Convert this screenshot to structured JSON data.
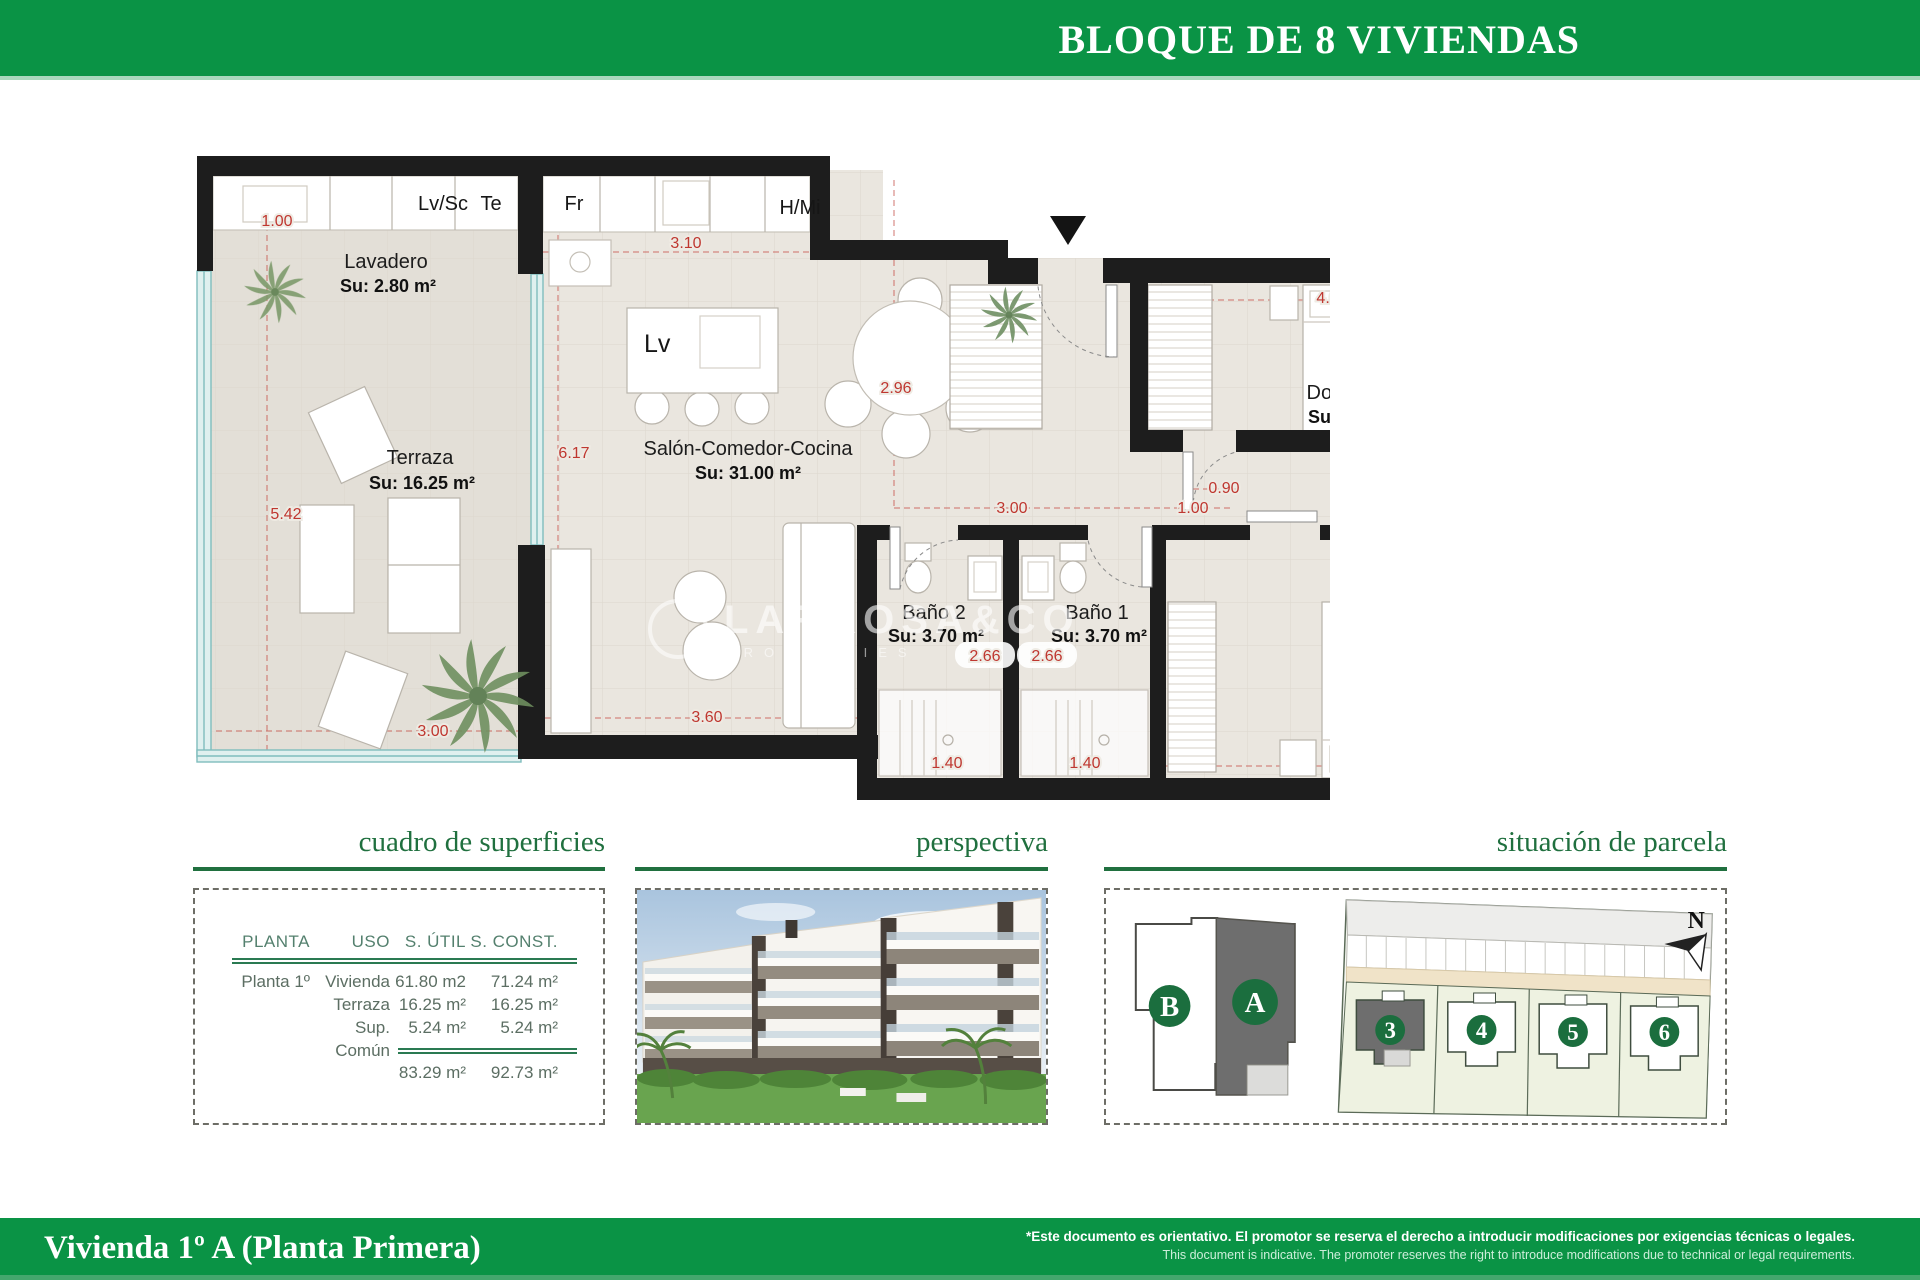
{
  "header": {
    "title": "BLOQUE DE 8 VIVIENDAS"
  },
  "plan": {
    "fixtures": {
      "lvsc": "Lv/Sc",
      "te": "Te",
      "fr": "Fr",
      "hmi": "H/Mi",
      "lv": "Lv"
    },
    "rooms": {
      "lavadero": {
        "name": "Lavadero",
        "su": "Su: 2.80 m²"
      },
      "terraza": {
        "name": "Terraza",
        "su": "Su: 16.25 m²"
      },
      "salon": {
        "name": "Salón-Comedor-Cocina",
        "su": "Su: 31.00 m²"
      },
      "bano2": {
        "name": "Baño 2",
        "su": "Su: 3.70 m²"
      },
      "bano1": {
        "name": "Baño 1",
        "su": "Su: 3.70 m²"
      },
      "dorm2": {
        "name": "Dormitorio 2",
        "su": "Su: 10.00 m²"
      },
      "dorm1": {
        "name": "Dormitorio 1",
        "su": "Su: 10.60 m²"
      }
    },
    "dims": {
      "left_top": "1.00",
      "kitchen_width": "3.10",
      "table": "2.96",
      "salon_height": "6.17",
      "terraza_height": "5.42",
      "terraza_width": "3.00",
      "salon_width": "3.60",
      "hall_width": "3.00",
      "hall_door": "1.00",
      "dorm2_door": "0.90",
      "dorm2_bed": "4.00",
      "dorm2_side": "2.65",
      "bano2_depth": "2.66",
      "bano1_depth": "2.66",
      "dorm1_side": "2.66",
      "bano2_width": "1.40",
      "bano1_width": "1.40",
      "dorm1_bed": "4.00"
    }
  },
  "watermark": {
    "line1": "LARROSA&CO",
    "line2": "PROPERTIES"
  },
  "sections": {
    "cuadro": {
      "title": "cuadro de superficies",
      "headers": [
        "PLANTA",
        "USO",
        "S. ÚTIL",
        "S. CONST."
      ],
      "rows": [
        {
          "planta": "Planta 1º",
          "uso": "Vivienda",
          "util": "61.80 m2",
          "cons": "71.24 m²"
        },
        {
          "planta": "",
          "uso": "Terraza",
          "util": "16.25 m²",
          "cons": "16.25 m²"
        },
        {
          "planta": "",
          "uso": "Sup. Común",
          "util": "5.24 m²",
          "cons": "5.24 m²"
        }
      ],
      "totals": {
        "util": "83.29 m²",
        "cons": "92.73 m²"
      }
    },
    "perspectiva": {
      "title": "perspectiva"
    },
    "situacion": {
      "title": "situación de parcela",
      "block_b": "B",
      "block_a": "A",
      "plots": [
        "3",
        "4",
        "5",
        "6"
      ],
      "north": "N"
    }
  },
  "footer": {
    "title": "Vivienda 1º A (Planta Primera)",
    "disclaimer_es": "*Este documento es orientativo. El promotor se reserva el derecho a introducir modificaciones por exigencias técnicas o legales.",
    "disclaimer_en": "This document is indicative. The promoter reserves the right to introduce modifications due to technical or legal requirements."
  }
}
